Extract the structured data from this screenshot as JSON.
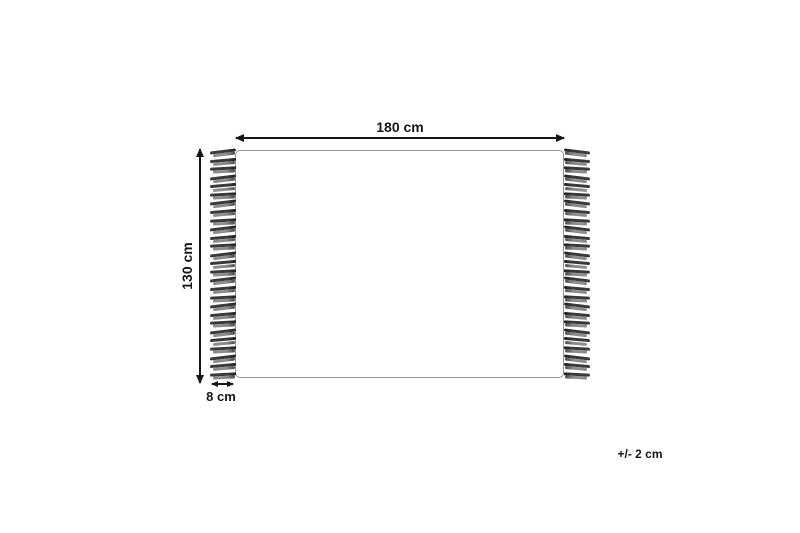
{
  "diagram": {
    "type": "product-dimension-diagram",
    "subject": "rug with side fringes",
    "width_label": "180 cm",
    "height_label": "130 cm",
    "fringe_label": "8 cm",
    "tolerance_label": "+/- 2 cm",
    "fringe": {
      "tassels_per_side": 27,
      "sides": [
        "left",
        "right"
      ]
    }
  },
  "colors": {
    "background": "#ffffff",
    "rug_outline": "#929292",
    "arrow": "#161616",
    "strand_dark": "#3a3a3a",
    "strand_light": "#8d8d8d"
  }
}
